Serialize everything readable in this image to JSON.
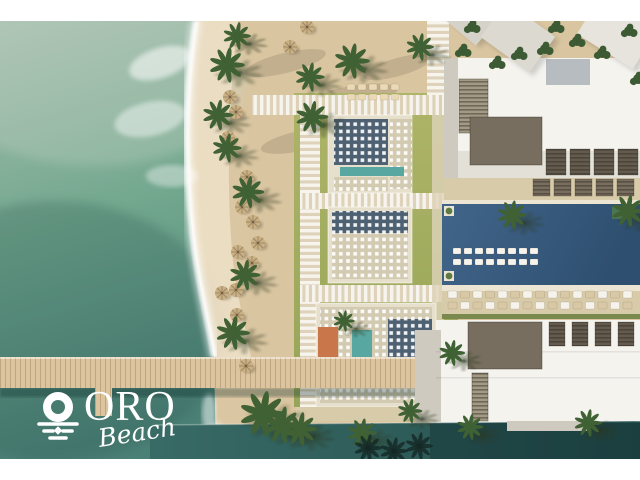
{
  "brand": {
    "name": "ORO",
    "tagline": "Beach",
    "logo_icon": "sun-over-waves-icon"
  },
  "palette": {
    "white": "#ffffff",
    "ocean-1": "#a8bfb0",
    "ocean-2": "#72a78e",
    "ocean-3": "#4b8076",
    "canal-1": "#386a66",
    "canal-2": "#254f4d",
    "sand": "#d9c5a0",
    "sand-wet": "#ecdfc5",
    "sand-light": "#e4d3b2",
    "pier": "#dcc49e",
    "grass-1": "#aeb468",
    "grass-2": "#96a557",
    "path": "#ded3ba",
    "pavil-frame": "#e6dfcb",
    "pavil-tan": "#d3cab2",
    "pavil-dark": "#4e6173",
    "pool-1": "#41658a",
    "pool-2": "#2e4f6f",
    "teal-pool": "#58a7a0",
    "deck": "#d8cba9",
    "bldg-1": "#f4f3ee",
    "bldg-2": "#e3e0d7",
    "bldg-3": "#cecabf",
    "roof-1": "#786e5f",
    "roof-2": "#635b4e",
    "roof-blue": "#b7bcc1",
    "louver": "#a39a86",
    "palm": "#3f6134",
    "flower": "#c9764a",
    "umbrella": "#c9b185"
  },
  "scene": {
    "palms": [
      [
        237,
        15,
        0.9
      ],
      [
        227,
        44,
        1.15
      ],
      [
        218,
        94,
        1.0
      ],
      [
        227,
        127,
        0.95
      ],
      [
        248,
        171,
        1.05
      ],
      [
        245,
        254,
        1.0
      ],
      [
        233,
        312,
        1.1
      ],
      [
        263,
        393,
        1.5
      ],
      [
        282,
        404,
        1.2
      ],
      [
        310,
        56,
        0.95
      ],
      [
        312,
        96,
        1.05
      ],
      [
        352,
        40,
        1.15
      ],
      [
        420,
        26,
        0.9
      ],
      [
        452,
        332,
        0.85
      ],
      [
        344,
        300,
        0.7
      ],
      [
        512,
        194,
        0.95
      ],
      [
        628,
        190,
        1.05
      ],
      [
        300,
        408,
        1.1
      ],
      [
        362,
        412,
        0.95
      ],
      [
        588,
        402,
        0.9
      ],
      [
        470,
        406,
        0.85
      ],
      [
        410,
        390,
        0.8
      ]
    ],
    "trees": [
      [
        472,
        6
      ],
      [
        463,
        30
      ],
      [
        519,
        33
      ],
      [
        556,
        6
      ],
      [
        577,
        20
      ],
      [
        602,
        32
      ],
      [
        629,
        10
      ],
      [
        638,
        58
      ],
      [
        497,
        42
      ],
      [
        545,
        28
      ]
    ],
    "umbrellas": [
      [
        230,
        76
      ],
      [
        236,
        91
      ],
      [
        228,
        117
      ],
      [
        247,
        156
      ],
      [
        242,
        186
      ],
      [
        253,
        201
      ],
      [
        258,
        222
      ],
      [
        238,
        231
      ],
      [
        252,
        242
      ],
      [
        222,
        272
      ],
      [
        236,
        269
      ],
      [
        237,
        294
      ],
      [
        246,
        345
      ],
      [
        290,
        26
      ],
      [
        307,
        6
      ]
    ],
    "lounger_rows": [
      {
        "x": 453,
        "y": 227,
        "dx": 11,
        "n": 8,
        "w": 8,
        "h": 6,
        "colors": [
          "#f6f3ec"
        ]
      },
      {
        "x": 453,
        "y": 238,
        "dx": 11,
        "n": 8,
        "w": 8,
        "h": 6,
        "colors": [
          "#f6f3ec"
        ]
      },
      {
        "x": 448,
        "y": 270,
        "dx": 12.5,
        "n": 15,
        "w": 9,
        "h": 7,
        "colors": [
          "#f6f3ec",
          "#d9c8a6"
        ]
      },
      {
        "x": 448,
        "y": 281,
        "dx": 12.5,
        "n": 15,
        "w": 9,
        "h": 7,
        "colors": [
          "#d9c8a6",
          "#f6f3ec"
        ]
      },
      {
        "x": 347,
        "y": 63,
        "dx": 11,
        "n": 5,
        "w": 8,
        "h": 6,
        "colors": [
          "#ead9b4"
        ]
      },
      {
        "x": 347,
        "y": 73,
        "dx": 11,
        "n": 5,
        "w": 8,
        "h": 6,
        "colors": [
          "#ead9b4"
        ]
      }
    ],
    "unit_rows": [
      {
        "x": 546,
        "y": 128,
        "dx": 24,
        "n": 4,
        "w": 20,
        "h": 26,
        "fill": "#635b4e"
      },
      {
        "x": 533,
        "y": 158,
        "dx": 21,
        "n": 5,
        "w": 17,
        "h": 17,
        "fill": "#786e5f"
      },
      {
        "x": 549,
        "y": 301,
        "dx": 23,
        "n": 4,
        "w": 16,
        "h": 24,
        "fill": "#635b4e"
      }
    ],
    "canal_silhouettes": [
      [
        368,
        427
      ],
      [
        394,
        430
      ],
      [
        419,
        425
      ]
    ]
  }
}
